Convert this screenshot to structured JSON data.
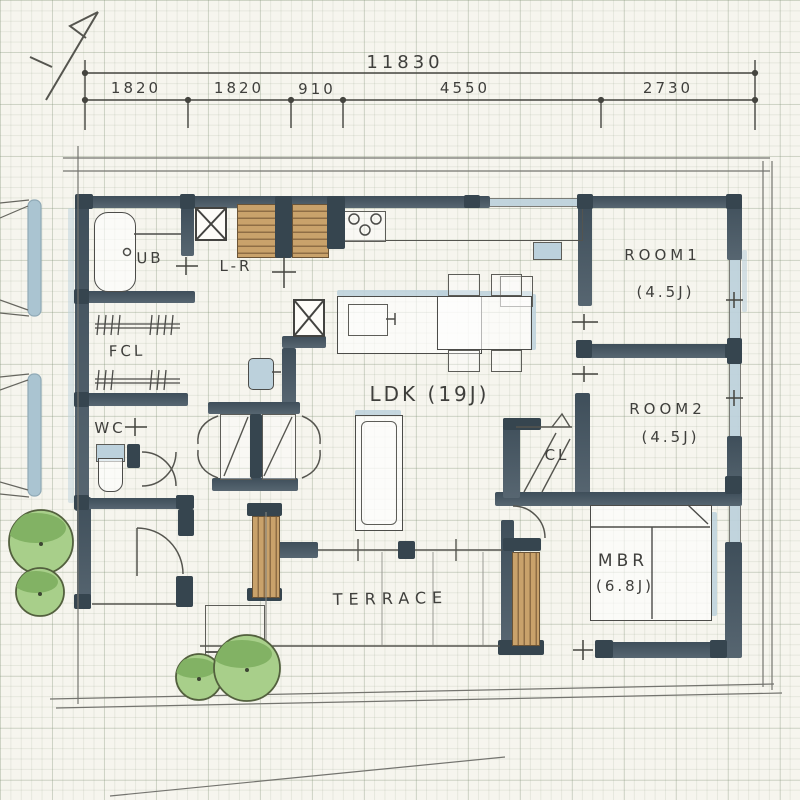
{
  "title": "hand-drawn house floor plan sketch",
  "dimensions": {
    "total": "11830",
    "segments": [
      "1820",
      "1820",
      "910",
      "4550",
      "2730"
    ]
  },
  "rooms": {
    "ub": "UB",
    "lr": "L-R",
    "fcl": "FCL",
    "wc": "WC",
    "ldk": "LDK (19J)",
    "room1": "ROOM1",
    "room1_size": "(4.5J)",
    "room2": "ROOM2",
    "room2_size": "(4.5J)",
    "cl": "CL",
    "mbr": "MBR",
    "mbr_size": "(6.8J)",
    "terrace": "TERRACE"
  },
  "colors": {
    "wall": "#4a5a66",
    "pillar": "#36454f",
    "wood": "#c9a26b",
    "water": "#bcd1dc",
    "tree_fill": "#a8cf8a",
    "tree_shade": "#82b264",
    "ink": "#3f3f3c",
    "paper": "#f6f5ee",
    "boundary": "#74746f"
  }
}
